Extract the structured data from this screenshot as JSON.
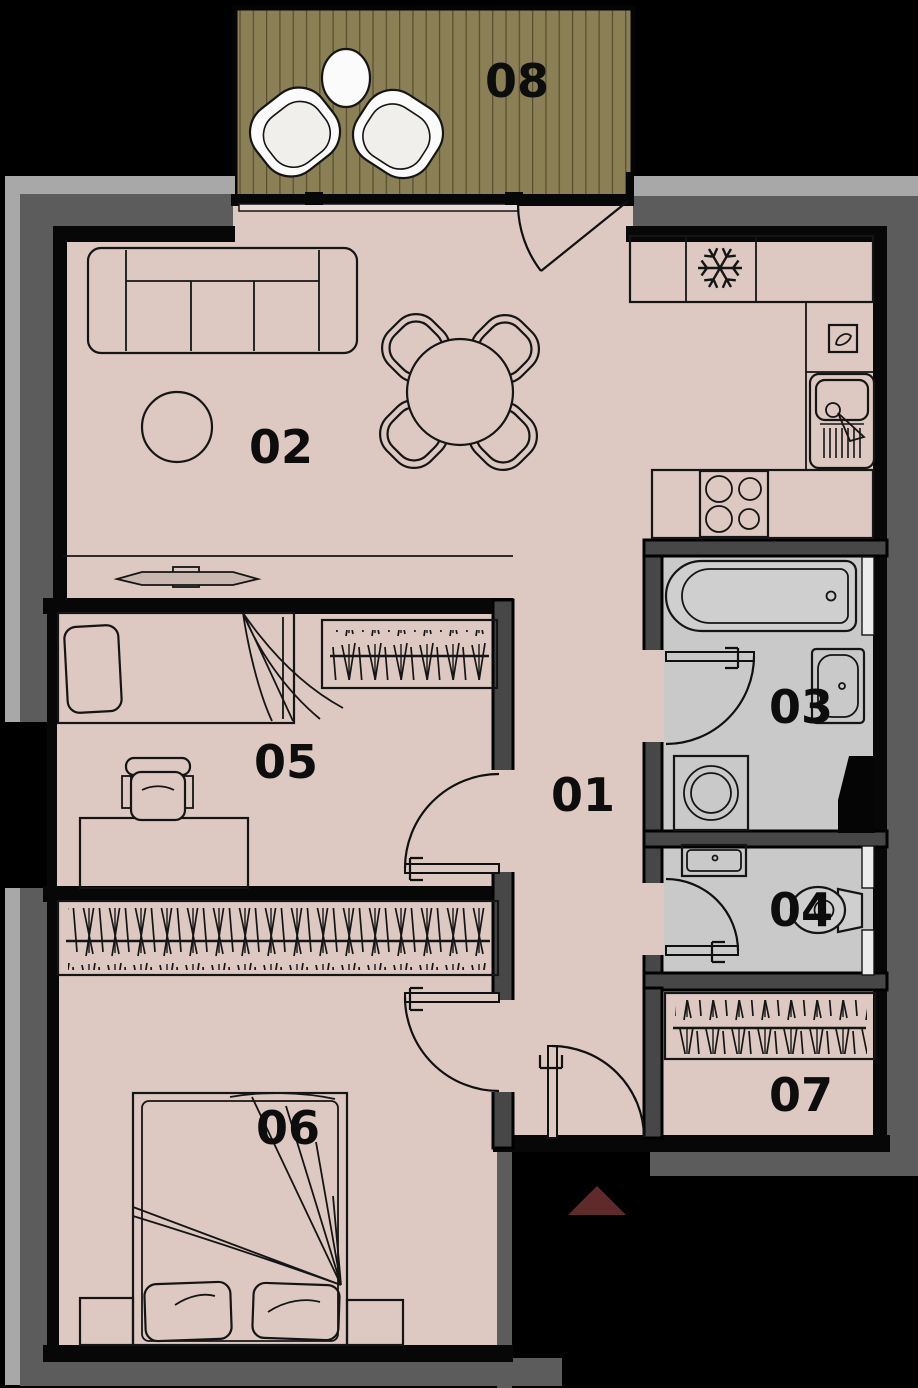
{
  "plan": {
    "title": "Apartment floor plan",
    "rooms": [
      {
        "number": "01",
        "type": "hallway"
      },
      {
        "number": "02",
        "type": "living-room-with-kitchen"
      },
      {
        "number": "03",
        "type": "bathroom"
      },
      {
        "number": "04",
        "type": "toilet"
      },
      {
        "number": "05",
        "type": "bedroom"
      },
      {
        "number": "06",
        "type": "bedroom"
      },
      {
        "number": "07",
        "type": "storage"
      },
      {
        "number": "08",
        "type": "balcony"
      }
    ],
    "fixtures": [
      "sofa",
      "rug",
      "dining-table",
      "tv-sideboard",
      "fridge",
      "kitchen-sink",
      "hob",
      "bathtub",
      "washbasin",
      "washing-machine",
      "duct-shaft",
      "toilet",
      "single-bed",
      "desk",
      "office-chair",
      "wardrobe",
      "double-bed",
      "nightstand",
      "balcony-table",
      "balcony-chair"
    ],
    "entrance_marker": {
      "shape": "triangle-up",
      "color": "#5e2a2a"
    },
    "colors": {
      "background": "#000000",
      "floor_living": "#ddc9c2",
      "floor_wet": "#c9c9c9",
      "balcony_deck": "#8b7f55",
      "wall_dark": "#474747",
      "wall_band_dark": "#5c5c5c",
      "wall_band_light": "#a8a8a8",
      "wall_black": "#070707"
    }
  }
}
